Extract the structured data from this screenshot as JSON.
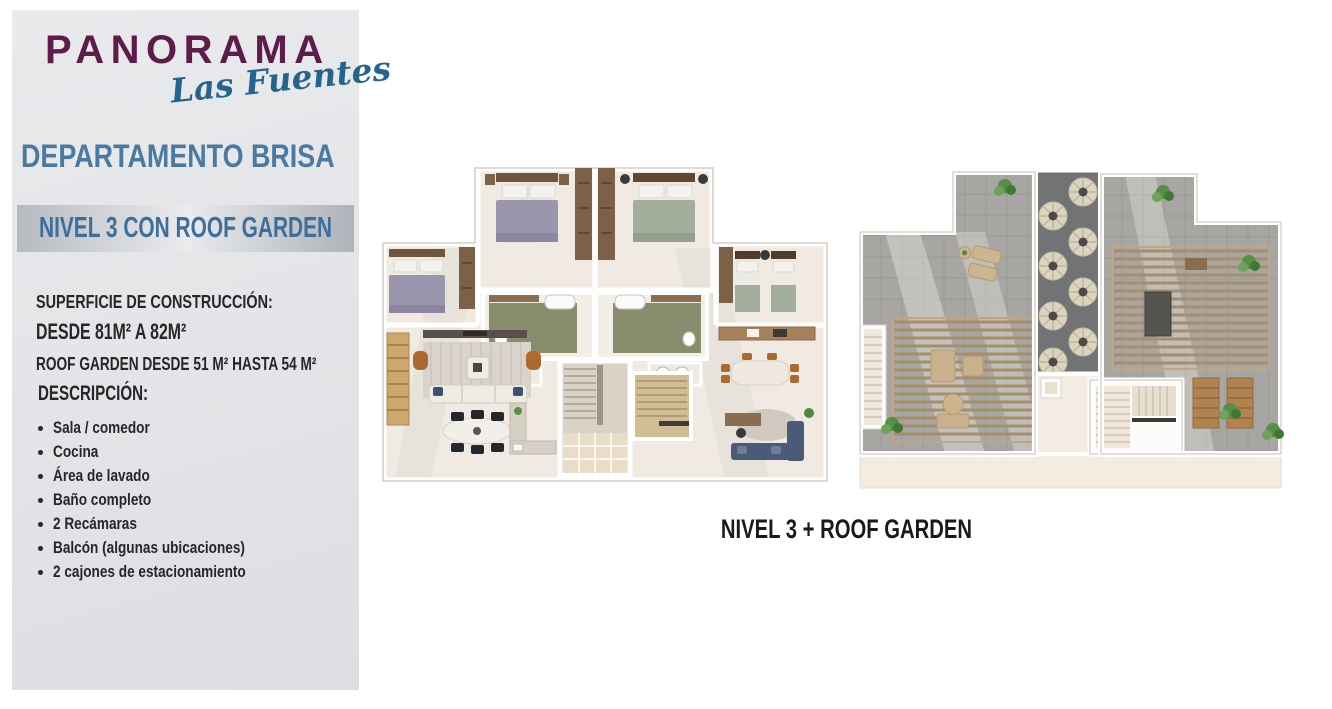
{
  "page": {
    "background_color": "#ffffff"
  },
  "sidebar": {
    "background_color": "#e2e4e7",
    "logo": {
      "brand": "PANORAMA",
      "subbrand": "Las Fuentes",
      "brand_color": "#5e1c4a",
      "subbrand_color": "#24658e"
    },
    "department_title": "DEPARTAMENTO BRISA",
    "department_title_color": "#4a7aa1",
    "level_banner": {
      "label": "NIVEL 3 CON ROOF GARDEN",
      "text_color": "#3d6f9a"
    },
    "surface": {
      "heading": "SUPERFICIE DE CONSTRUCCIÓN:",
      "range_line": "DESDE 81M² A 82M²",
      "roof_garden_line": "ROOF GARDEN DESDE 51 M² HASTA 54 M²"
    },
    "description": {
      "heading": "DESCRIPCIÓN:",
      "items": [
        "Sala / comedor",
        "Cocina",
        "Área de lavado",
        "Baño completo",
        "2 Recámaras",
        "Balcón (algunas ubicaciones)",
        "2 cajones de estacionamiento"
      ]
    }
  },
  "main": {
    "caption": "NIVEL 3 + ROOF GARDEN",
    "caption_color": "#1a1a1a"
  }
}
